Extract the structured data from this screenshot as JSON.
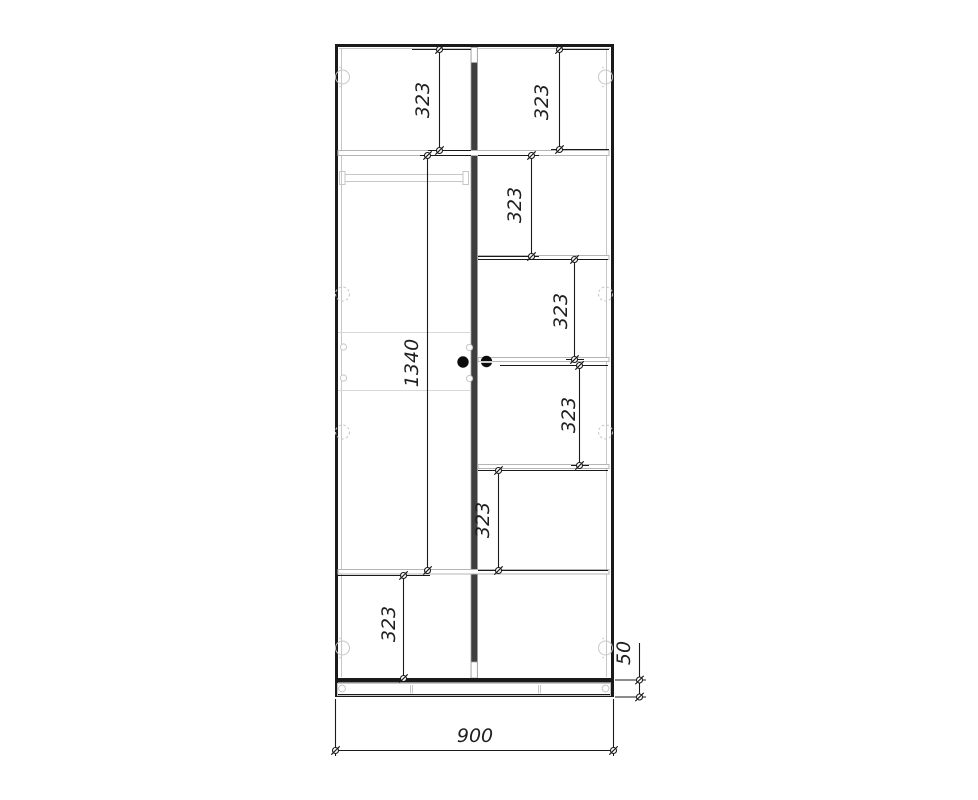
{
  "drawing": {
    "kind": "wardrobe front elevation technical drawing",
    "units": "mm",
    "background": "#ffffff",
    "line_colors": {
      "outline": "#1a1a1a",
      "divider_panel": "#3f3f3f",
      "shelf": "#b5b5b5",
      "fitting": "#c7c7c7",
      "dimension": "#1a1a1a"
    },
    "dimensions": [
      {
        "value": "323",
        "orientation": "vertical",
        "measures": "left top compartment height"
      },
      {
        "value": "323",
        "orientation": "vertical",
        "measures": "right top compartment height"
      },
      {
        "value": "323",
        "orientation": "vertical",
        "measures": "right second compartment height"
      },
      {
        "value": "323",
        "orientation": "vertical",
        "measures": "right third compartment height"
      },
      {
        "value": "323",
        "orientation": "vertical",
        "measures": "right fourth compartment height"
      },
      {
        "value": "323",
        "orientation": "vertical",
        "measures": "right fifth compartment height"
      },
      {
        "value": "1340",
        "orientation": "vertical",
        "measures": "left hanging section height"
      },
      {
        "value": "323",
        "orientation": "vertical",
        "measures": "left bottom compartment height"
      },
      {
        "value": "50",
        "orientation": "vertical",
        "measures": "plinth height"
      },
      {
        "value": "900",
        "orientation": "horizontal",
        "measures": "overall cabinet width"
      }
    ],
    "components": {
      "center_divider": 1,
      "hanging_rail": 1,
      "door_handles": 2,
      "right_side_shelves": 5,
      "edge_cam_fittings": 8
    }
  }
}
